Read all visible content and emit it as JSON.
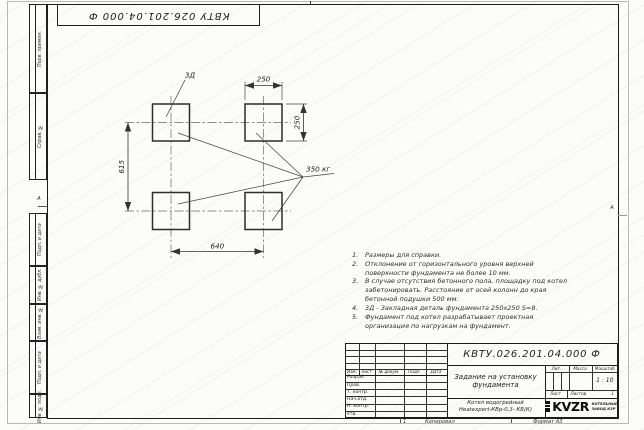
{
  "frame": {
    "top_designation": "КВТУ 026.201.04.000 Ф",
    "zone_marker": "А",
    "side_labels": [
      "Перв. примен.",
      "Справ. №",
      "Подп. и дата",
      "Инв. № дубл.",
      "Взам. инв. №",
      "Подп. и дата",
      "Инв. № подл."
    ]
  },
  "plan": {
    "leader_embed_label": "3Д",
    "dim_top": "250",
    "dim_right": "250",
    "dim_left": "615",
    "dim_bottom": "640",
    "load_label": "350 кг"
  },
  "notes": {
    "items": [
      {
        "num": "1.",
        "text": "Размеры для справки."
      },
      {
        "num": "2.",
        "text": "Отклонение от горизонтального уровня верхней поверхности фундамента не более 10 мм."
      },
      {
        "num": "3.",
        "text": "В случае отсутствия бетонного пола, площадку под котел забетонировать. Расстояние от осей колонн до края бетонной подушки 500 мм."
      },
      {
        "num": "4.",
        "text": "3Д - Закладная деталь фундамента 250х250 S=8."
      },
      {
        "num": "5.",
        "text": "Фундамент под котел разрабатывает проектная организация по нагрузкам на фундамент."
      }
    ]
  },
  "title_block": {
    "designation": "КВТУ.026.201.04.000 Ф",
    "title_line1": "Задание на установку",
    "title_line2": "фундамента",
    "product_line1": "Котел водогрейный",
    "product_line2": "Heatexpert-КВр-0,3- КБ(К)",
    "col_izm": "Изм.",
    "col_list": "Лист",
    "col_docnum": "№ докум.",
    "col_podp": "Подп.",
    "col_data": "Дата",
    "rows": [
      "Разраб.",
      "Пров.",
      "Т. контр.",
      "Нач.отд.",
      "Н. контр.",
      "Утв."
    ],
    "lit_label": "Лит.",
    "mass_label": "Масса",
    "scale_label": "Масштаб",
    "scale_value": "1 : 10",
    "sheet_label": "Лист",
    "sheets_label": "Листов",
    "sheets_value": "1",
    "logo_text": "KVZR",
    "company_line1": "КОТЕЛЬНЫЙ",
    "company_line2": "ЗАВОД КЗР"
  },
  "footer": {
    "copied_label": "Копировал",
    "format_label": "Формат А3",
    "sheet_mark": "1"
  }
}
